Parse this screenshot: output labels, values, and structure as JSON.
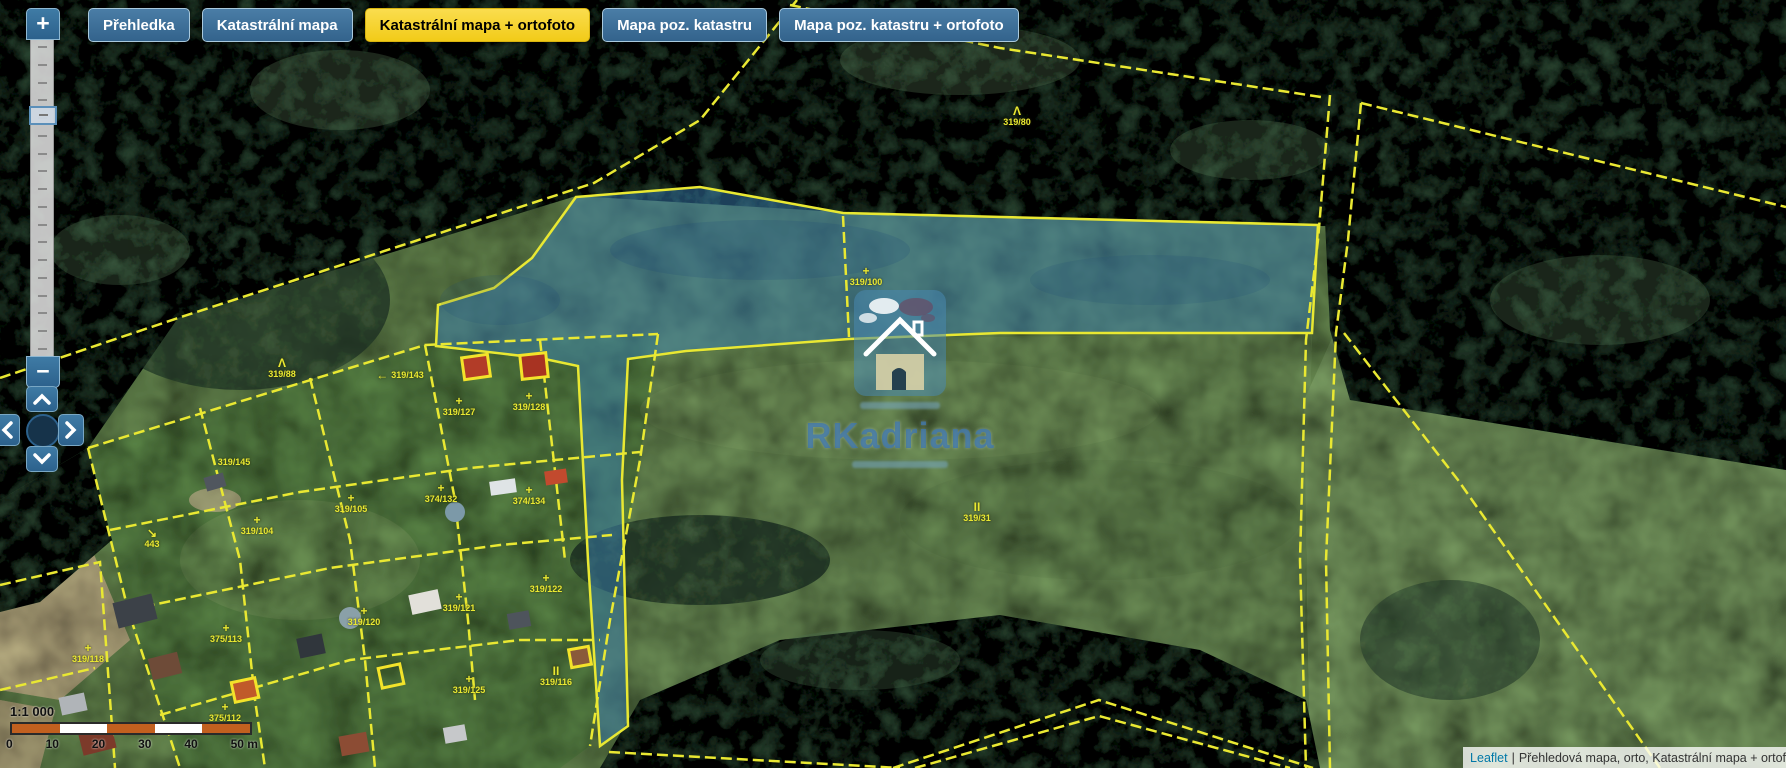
{
  "tabs": [
    {
      "label": "Přehledka",
      "active": false
    },
    {
      "label": "Katastrální mapa",
      "active": false
    },
    {
      "label": "Katastrální mapa + ortofoto",
      "active": true
    },
    {
      "label": "Mapa poz. katastru",
      "active": false
    },
    {
      "label": "Mapa poz. katastru + ortofoto",
      "active": false
    }
  ],
  "zoom_control": {
    "zoom_in_label": "+",
    "zoom_out_label": "−",
    "tick_count": 18,
    "icons": {
      "pan_up": "chevron-up",
      "pan_down": "chevron-down",
      "pan_left": "chevron-left",
      "pan_right": "chevron-right"
    }
  },
  "scale_bar": {
    "ratio": "1:1 000",
    "tick_0": "0",
    "tick_1": "10",
    "tick_2": "20",
    "tick_3": "30",
    "tick_4": "40",
    "tick_5": "50 m"
  },
  "attribution": {
    "library": "Leaflet",
    "separator": "|",
    "layers": "Přehledová mapa, orto, Katastrální mapa + ortof"
  },
  "watermark": {
    "brand": "RKadriana"
  },
  "map": {
    "highlighted_parcel": "319/100",
    "labels": [
      {
        "sym": "Λ",
        "text": "319/80"
      },
      {
        "sym": "+",
        "text": "319/100"
      },
      {
        "sym": "II",
        "text": "319/31"
      },
      {
        "sym": "Λ",
        "text": "319/88"
      },
      {
        "sym": "←",
        "text": "319/143"
      },
      {
        "sym": "+",
        "text": "319/127"
      },
      {
        "sym": "+",
        "text": "319/128"
      },
      {
        "sym": "",
        "text": "319/145"
      },
      {
        "sym": "↘",
        "text": "443"
      },
      {
        "sym": "+",
        "text": "319/104"
      },
      {
        "sym": "+",
        "text": "319/105"
      },
      {
        "sym": "+",
        "text": "374/132"
      },
      {
        "sym": "+",
        "text": "374/134"
      },
      {
        "sym": "+",
        "text": "319/120"
      },
      {
        "sym": "+",
        "text": "319/121"
      },
      {
        "sym": "+",
        "text": "319/122"
      },
      {
        "sym": "+",
        "text": "319/125"
      },
      {
        "sym": "II",
        "text": "319/116"
      },
      {
        "sym": "+",
        "text": "375/113"
      },
      {
        "sym": "+",
        "text": "375/112"
      },
      {
        "sym": "+",
        "text": "319/118"
      }
    ]
  },
  "colors": {
    "tab_active": "#f2cb18",
    "line_yellow": "#e9e832",
    "parcel_blue": "rgba(58,128,180,0.5)",
    "scale_orange": "#c2601f",
    "leaflet_link": "#0078a8"
  }
}
